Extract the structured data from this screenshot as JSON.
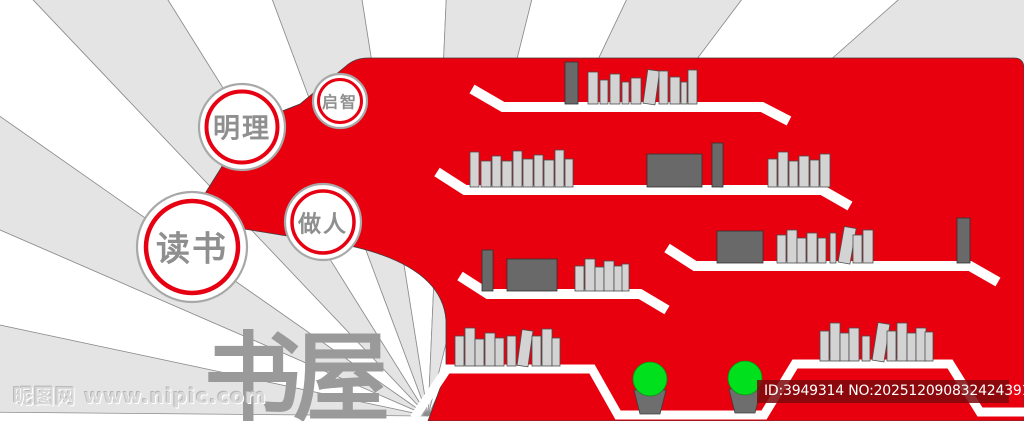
{
  "canvas": {
    "w": 1024,
    "h": 421
  },
  "colors": {
    "red_wall": "#e8000f",
    "red_wall_outline": "#3f3f3f",
    "ray_gray": "#e4e4e4",
    "ray_white": "#ffffff",
    "ray_stroke": "#8d8d8d",
    "shelf_white": "#ffffff",
    "book_light": "#d3d3d3",
    "book_light_stroke": "#4d4d4d",
    "book_dark": "#696969",
    "book_dark_stroke": "#303030",
    "plant_green": "#00e01c",
    "plant_green_stroke": "#0b8f12",
    "pot_gray": "#6e6e6e",
    "pot_stroke": "#3c3c3c",
    "badge_ring_red": "#e60012",
    "badge_edge_gray": "#a8a8a8",
    "badge_text_gray": "#8f8f8f",
    "title_gray": "#9a9a9a",
    "id_bar_bg": "#7e090d",
    "id_bar_text": "#ffffff"
  },
  "sunburst": {
    "cx": 428,
    "cy": 416,
    "radius": 1400,
    "start_deg": -179.5,
    "step_deg": 11.5,
    "count": 13
  },
  "red_wall": {
    "path": "M 368,58 L 1014,58 Q 1024,58 1024,69 L 1024,421 L 428,421 L 446,372 L 446,320 Q 442,268 355,247 L 238,228 L 194,211 L 226,160 L 262,119 L 300,104 L 346,66 Q 355,58 368,58 Z"
  },
  "floor_line": {
    "width": 9,
    "points": [
      [
        414,
        418
      ],
      [
        447,
        369
      ],
      [
        592,
        369
      ],
      [
        618,
        415
      ],
      [
        764,
        415
      ],
      [
        795,
        364
      ],
      [
        950,
        364
      ],
      [
        980,
        412
      ],
      [
        1026,
        412
      ]
    ]
  },
  "shelves": [
    {
      "width": 10,
      "points": [
        [
          472,
          89
        ],
        [
          503,
          107
        ],
        [
          762,
          107
        ],
        [
          789,
          121
        ]
      ]
    },
    {
      "width": 10,
      "points": [
        [
          437,
          172
        ],
        [
          465,
          190
        ],
        [
          822,
          190
        ],
        [
          850,
          206
        ]
      ]
    },
    {
      "width": 10,
      "points": [
        [
          667,
          248
        ],
        [
          695,
          266
        ],
        [
          970,
          266
        ],
        [
          998,
          282
        ]
      ]
    },
    {
      "width": 10,
      "points": [
        [
          460,
          276
        ],
        [
          488,
          294
        ],
        [
          640,
          294
        ],
        [
          667,
          310
        ]
      ]
    }
  ],
  "books": [
    [
      565,
      104,
      13,
      42,
      0,
      1
    ],
    [
      588,
      104,
      10,
      32,
      0,
      0
    ],
    [
      600,
      104,
      8,
      24,
      0,
      0
    ],
    [
      610,
      104,
      10,
      30,
      0,
      0
    ],
    [
      622,
      104,
      7,
      22,
      0,
      0
    ],
    [
      631,
      104,
      10,
      26,
      0,
      0
    ],
    [
      643,
      104,
      12,
      34,
      8,
      0
    ],
    [
      659,
      104,
      9,
      33,
      0,
      0
    ],
    [
      670,
      104,
      10,
      27,
      0,
      0
    ],
    [
      681,
      104,
      6,
      22,
      0,
      0
    ],
    [
      688,
      104,
      9,
      34,
      0,
      0
    ],
    [
      470,
      187,
      9,
      35,
      0,
      0
    ],
    [
      481,
      187,
      10,
      26,
      0,
      0
    ],
    [
      492,
      187,
      9,
      31,
      0,
      0
    ],
    [
      502,
      187,
      10,
      26,
      0,
      0
    ],
    [
      513,
      187,
      9,
      36,
      0,
      0
    ],
    [
      523,
      187,
      10,
      28,
      0,
      0
    ],
    [
      534,
      187,
      9,
      32,
      0,
      0
    ],
    [
      544,
      187,
      10,
      27,
      0,
      0
    ],
    [
      555,
      187,
      9,
      37,
      0,
      0
    ],
    [
      565,
      187,
      8,
      28,
      0,
      0
    ],
    [
      647,
      187,
      55,
      33,
      0,
      1
    ],
    [
      712,
      187,
      11,
      44,
      0,
      1
    ],
    [
      768,
      187,
      9,
      28,
      0,
      0
    ],
    [
      778,
      187,
      10,
      35,
      0,
      0
    ],
    [
      789,
      187,
      9,
      26,
      0,
      0
    ],
    [
      799,
      187,
      10,
      31,
      0,
      0
    ],
    [
      810,
      187,
      9,
      27,
      0,
      0
    ],
    [
      820,
      187,
      10,
      33,
      0,
      0
    ],
    [
      717,
      263,
      46,
      32,
      0,
      1
    ],
    [
      777,
      263,
      9,
      28,
      0,
      0
    ],
    [
      787,
      263,
      10,
      33,
      0,
      0
    ],
    [
      797,
      263,
      9,
      25,
      0,
      0
    ],
    [
      807,
      263,
      10,
      30,
      0,
      0
    ],
    [
      818,
      263,
      8,
      25,
      0,
      0
    ],
    [
      830,
      263,
      6,
      30,
      0,
      0
    ],
    [
      838,
      263,
      12,
      36,
      10,
      0
    ],
    [
      853,
      263,
      9,
      28,
      0,
      0
    ],
    [
      863,
      263,
      10,
      33,
      0,
      0
    ],
    [
      957,
      263,
      13,
      45,
      0,
      1
    ],
    [
      482,
      291,
      11,
      41,
      0,
      1
    ],
    [
      507,
      291,
      50,
      32,
      0,
      1
    ],
    [
      575,
      291,
      9,
      25,
      0,
      0
    ],
    [
      585,
      291,
      10,
      32,
      0,
      0
    ],
    [
      595,
      291,
      9,
      24,
      0,
      0
    ],
    [
      604,
      291,
      10,
      30,
      0,
      0
    ],
    [
      614,
      291,
      9,
      25,
      0,
      0
    ],
    [
      622,
      291,
      7,
      27,
      0,
      0
    ],
    [
      455,
      366,
      9,
      30,
      0,
      0
    ],
    [
      465,
      366,
      10,
      38,
      0,
      0
    ],
    [
      475,
      366,
      9,
      27,
      0,
      0
    ],
    [
      485,
      366,
      10,
      33,
      0,
      0
    ],
    [
      495,
      366,
      9,
      28,
      0,
      0
    ],
    [
      507,
      366,
      9,
      30,
      0,
      0
    ],
    [
      517,
      366,
      11,
      36,
      8,
      0
    ],
    [
      532,
      366,
      9,
      30,
      0,
      0
    ],
    [
      542,
      366,
      10,
      37,
      0,
      0
    ],
    [
      552,
      366,
      8,
      28,
      0,
      0
    ],
    [
      820,
      361,
      9,
      30,
      0,
      0
    ],
    [
      830,
      361,
      10,
      38,
      0,
      0
    ],
    [
      840,
      361,
      9,
      28,
      0,
      0
    ],
    [
      849,
      361,
      10,
      33,
      0,
      0
    ],
    [
      862,
      361,
      8,
      25,
      0,
      0
    ],
    [
      872,
      361,
      12,
      38,
      9,
      0
    ],
    [
      887,
      361,
      9,
      30,
      0,
      0
    ],
    [
      897,
      361,
      10,
      38,
      0,
      0
    ],
    [
      907,
      361,
      9,
      28,
      0,
      0
    ],
    [
      916,
      361,
      10,
      33,
      0,
      0
    ],
    [
      925,
      361,
      8,
      29,
      0,
      0
    ]
  ],
  "plants": [
    {
      "ball": [
        650,
        379,
        17
      ],
      "pot": [
        [
          634,
          390
        ],
        [
          666,
          390
        ],
        [
          660,
          414
        ],
        [
          640,
          414
        ]
      ]
    },
    {
      "ball": [
        745,
        378,
        17
      ],
      "pot": [
        [
          729,
          389
        ],
        [
          761,
          389
        ],
        [
          755,
          413
        ],
        [
          735,
          413
        ]
      ]
    }
  ],
  "circles": [
    {
      "id": "dushu",
      "label": "读书",
      "cx": 192,
      "cy": 247,
      "r": 55,
      "ring_r": 46,
      "ring_w": 4.5,
      "font": 34
    },
    {
      "id": "mingli",
      "label": "明理",
      "cx": 242,
      "cy": 127,
      "r": 43,
      "ring_r": 35.5,
      "ring_w": 4,
      "font": 27
    },
    {
      "id": "zuoren",
      "label": "做人",
      "cx": 323,
      "cy": 222,
      "r": 38,
      "ring_r": 31,
      "ring_w": 3.5,
      "font": 23
    },
    {
      "id": "qizhi",
      "label": "启智",
      "cx": 340,
      "cy": 101,
      "r": 27,
      "ring_r": 21.5,
      "ring_w": 3,
      "font": 16
    }
  ],
  "title": {
    "text": "书屋"
  },
  "watermark": {
    "text": "昵图网 www.nipic.com"
  },
  "id_bar": {
    "text": "ID:3949314 NO:20251209083242439108"
  }
}
